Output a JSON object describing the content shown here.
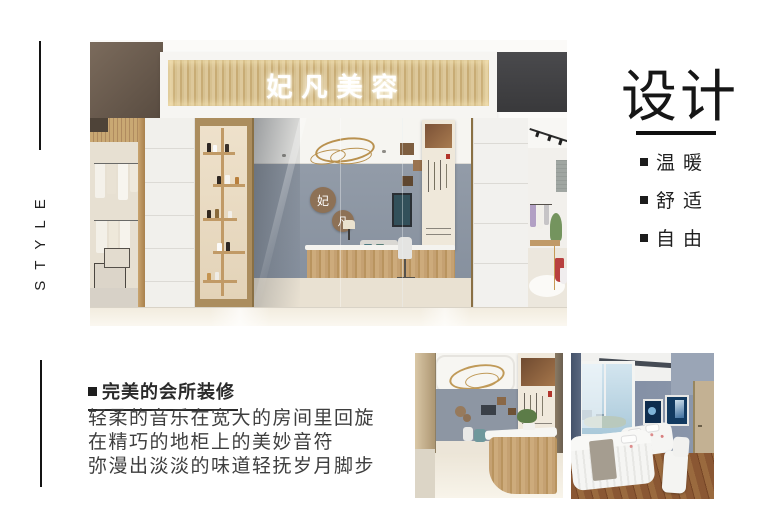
{
  "left_rail": {
    "style_text": "STYLE"
  },
  "hero": {
    "sign_text": "妃凡美容",
    "wall_logo": [
      "妃",
      "凡"
    ]
  },
  "right_panel": {
    "title": "设计",
    "features": [
      {
        "label": "温暖"
      },
      {
        "label": "舒适"
      },
      {
        "label": "自由"
      }
    ],
    "accent_color": "#111111"
  },
  "article": {
    "heading": "完美的会所装修",
    "lines": [
      "轻柔的音乐在宽大的房间里回旋",
      "在精巧的地柜上的美妙音符",
      "弥漫出淡淡的味道轻抚岁月脚步"
    ]
  },
  "colors": {
    "sign_wood": "#d3bd8e",
    "interior_wall": "#8c95a2",
    "ring_gold": "#b9914f",
    "walkway_floor": "#f3ede1",
    "treatment_floor_wood": "#8a5733",
    "text_dark": "#1f1f1f"
  }
}
